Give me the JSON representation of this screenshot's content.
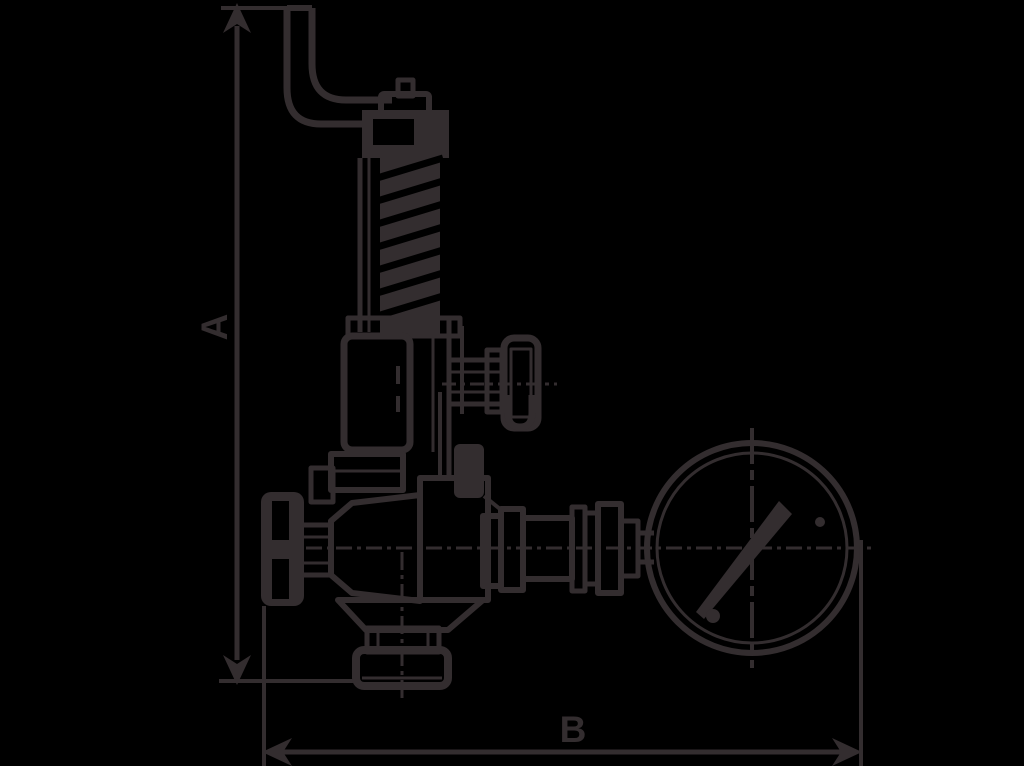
{
  "colors": {
    "background": "#000000",
    "ink": "#332d2f"
  },
  "dimension_a": {
    "label": "A"
  },
  "dimension_b": {
    "label": "B"
  },
  "drawing_parts": [
    "lever-arm",
    "adjusting-screw",
    "cap-nut",
    "spring-top-plate",
    "spring-coil",
    "bonnet-flange",
    "spring-housing",
    "side-stem",
    "side-handwheel",
    "clevis",
    "main-handwheel",
    "wheel-stem",
    "inlet-bell",
    "valve-body",
    "lower-trapezoid",
    "bottom-flange",
    "outlet-fittings",
    "gauge-pipe",
    "pressure-gauge",
    "gauge-needle",
    "gauge-dial-dots",
    "centerlines",
    "dimension-lines"
  ]
}
